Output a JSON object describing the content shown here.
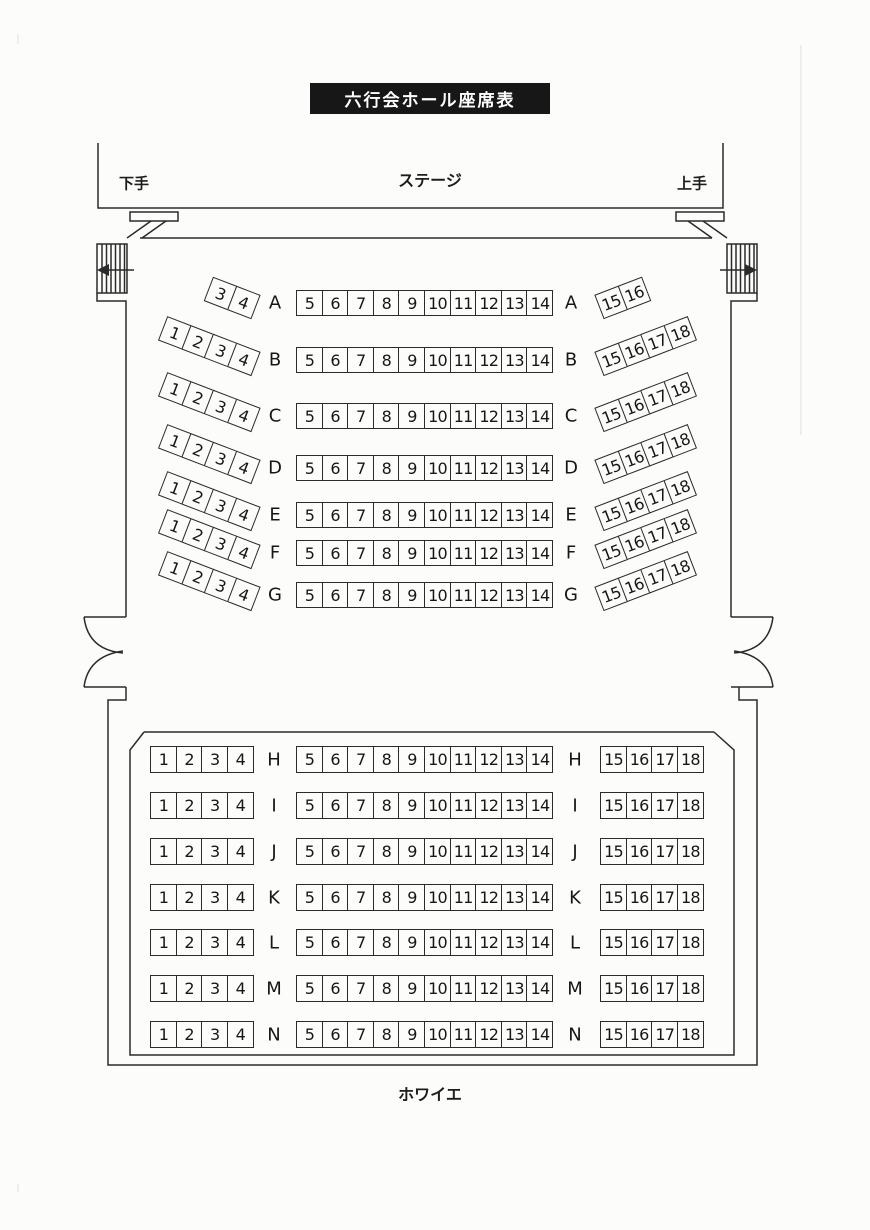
{
  "title": "六行会ホール座席表",
  "stage": {
    "label": "ステージ",
    "left_wing_label": "下手",
    "right_wing_label": "上手"
  },
  "foyer_label": "ホワイエ",
  "colors": {
    "line": "#2b2b2b",
    "banner_bg": "#171717",
    "banner_text": "#ffffff",
    "paper": "#fcfcfb"
  },
  "sections": {
    "front": {
      "rows": [
        {
          "letter": "A",
          "left": [
            "3",
            "4"
          ],
          "center": [
            "5",
            "6",
            "7",
            "8",
            "9",
            "10",
            "11",
            "12",
            "13",
            "14"
          ],
          "right": [
            "15",
            "16"
          ]
        },
        {
          "letter": "B",
          "left": [
            "1",
            "2",
            "3",
            "4"
          ],
          "center": [
            "5",
            "6",
            "7",
            "8",
            "9",
            "10",
            "11",
            "12",
            "13",
            "14"
          ],
          "right": [
            "15",
            "16",
            "17",
            "18"
          ]
        },
        {
          "letter": "C",
          "left": [
            "1",
            "2",
            "3",
            "4"
          ],
          "center": [
            "5",
            "6",
            "7",
            "8",
            "9",
            "10",
            "11",
            "12",
            "13",
            "14"
          ],
          "right": [
            "15",
            "16",
            "17",
            "18"
          ]
        },
        {
          "letter": "D",
          "left": [
            "1",
            "2",
            "3",
            "4"
          ],
          "center": [
            "5",
            "6",
            "7",
            "8",
            "9",
            "10",
            "11",
            "12",
            "13",
            "14"
          ],
          "right": [
            "15",
            "16",
            "17",
            "18"
          ]
        },
        {
          "letter": "E",
          "left": [
            "1",
            "2",
            "3",
            "4"
          ],
          "center": [
            "5",
            "6",
            "7",
            "8",
            "9",
            "10",
            "11",
            "12",
            "13",
            "14"
          ],
          "right": [
            "15",
            "16",
            "17",
            "18"
          ]
        },
        {
          "letter": "F",
          "left": [
            "1",
            "2",
            "3",
            "4"
          ],
          "center": [
            "5",
            "6",
            "7",
            "8",
            "9",
            "10",
            "11",
            "12",
            "13",
            "14"
          ],
          "right": [
            "15",
            "16",
            "17",
            "18"
          ]
        },
        {
          "letter": "G",
          "left": [
            "1",
            "2",
            "3",
            "4"
          ],
          "center": [
            "5",
            "6",
            "7",
            "8",
            "9",
            "10",
            "11",
            "12",
            "13",
            "14"
          ],
          "right": [
            "15",
            "16",
            "17",
            "18"
          ]
        }
      ]
    },
    "rear": {
      "rows": [
        {
          "letter": "H",
          "left": [
            "1",
            "2",
            "3",
            "4"
          ],
          "center": [
            "5",
            "6",
            "7",
            "8",
            "9",
            "10",
            "11",
            "12",
            "13",
            "14"
          ],
          "right": [
            "15",
            "16",
            "17",
            "18"
          ]
        },
        {
          "letter": "I",
          "left": [
            "1",
            "2",
            "3",
            "4"
          ],
          "center": [
            "5",
            "6",
            "7",
            "8",
            "9",
            "10",
            "11",
            "12",
            "13",
            "14"
          ],
          "right": [
            "15",
            "16",
            "17",
            "18"
          ]
        },
        {
          "letter": "J",
          "left": [
            "1",
            "2",
            "3",
            "4"
          ],
          "center": [
            "5",
            "6",
            "7",
            "8",
            "9",
            "10",
            "11",
            "12",
            "13",
            "14"
          ],
          "right": [
            "15",
            "16",
            "17",
            "18"
          ]
        },
        {
          "letter": "K",
          "left": [
            "1",
            "2",
            "3",
            "4"
          ],
          "center": [
            "5",
            "6",
            "7",
            "8",
            "9",
            "10",
            "11",
            "12",
            "13",
            "14"
          ],
          "right": [
            "15",
            "16",
            "17",
            "18"
          ]
        },
        {
          "letter": "L",
          "left": [
            "1",
            "2",
            "3",
            "4"
          ],
          "center": [
            "5",
            "6",
            "7",
            "8",
            "9",
            "10",
            "11",
            "12",
            "13",
            "14"
          ],
          "right": [
            "15",
            "16",
            "17",
            "18"
          ]
        },
        {
          "letter": "M",
          "left": [
            "1",
            "2",
            "3",
            "4"
          ],
          "center": [
            "5",
            "6",
            "7",
            "8",
            "9",
            "10",
            "11",
            "12",
            "13",
            "14"
          ],
          "right": [
            "15",
            "16",
            "17",
            "18"
          ]
        },
        {
          "letter": "N",
          "left": [
            "1",
            "2",
            "3",
            "4"
          ],
          "center": [
            "5",
            "6",
            "7",
            "8",
            "9",
            "10",
            "11",
            "12",
            "13",
            "14"
          ],
          "right": [
            "15",
            "16",
            "17",
            "18"
          ]
        }
      ]
    }
  }
}
